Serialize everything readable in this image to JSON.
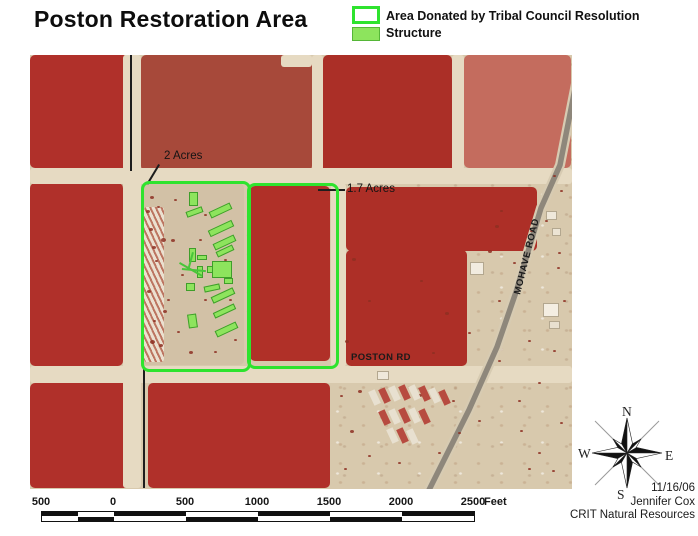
{
  "title": "Poston Restoration Area",
  "legend": {
    "items": [
      {
        "label": "Area Donated by Tribal Council Resolution",
        "swatch": "green-outline",
        "color": "#2ee32e"
      },
      {
        "label": "Structure",
        "swatch": "green-fill",
        "color": "#8de45d"
      }
    ]
  },
  "map": {
    "labels": {
      "area1": "2 Acres",
      "area2": "1.7 Acres",
      "poston_rd": "POSTON RD",
      "mohave_road": "MOHAVE ROAD"
    },
    "colors": {
      "boundary_green": "#2ee32e",
      "structure_green": "#8de45d",
      "field_red": "#b0302a",
      "desert_tan": "#d8c9ad"
    },
    "fields": [
      {
        "x": 0,
        "y": 0,
        "w": 98,
        "h": 113,
        "c": "#b0302a"
      },
      {
        "x": 111,
        "y": 0,
        "w": 171,
        "h": 116,
        "c": "#a7493a",
        "t": "mottled"
      },
      {
        "x": 293,
        "y": 0,
        "w": 129,
        "h": 118,
        "c": "#ab2f27",
        "t": "mottled"
      },
      {
        "x": 434,
        "y": 0,
        "w": 107,
        "h": 113,
        "c": "#c46c5e",
        "t": "mottled"
      },
      {
        "x": 0,
        "y": 128,
        "w": 93,
        "h": 183,
        "c": "#b0302a"
      },
      {
        "x": 316,
        "y": 132,
        "w": 191,
        "h": 64,
        "c": "#ad2f27"
      },
      {
        "x": 316,
        "y": 195,
        "w": 121,
        "h": 116,
        "c": "#ad2f27"
      },
      {
        "x": 220,
        "y": 131,
        "w": 80,
        "h": 175,
        "c": "#b03028"
      },
      {
        "x": 0,
        "y": 328,
        "w": 107,
        "h": 105,
        "c": "#b0302a"
      },
      {
        "x": 118,
        "y": 328,
        "w": 182,
        "h": 105,
        "c": "#b0302a"
      },
      {
        "x": 112,
        "y": 128,
        "w": 102,
        "h": 182,
        "c": "#d2c1a6",
        "t": "camp"
      },
      {
        "x": 114,
        "y": 152,
        "w": 20,
        "h": 155,
        "t": "ruins"
      }
    ],
    "roads": [
      {
        "x": 0,
        "y": 113,
        "w": 542,
        "h": 16
      },
      {
        "x": 0,
        "y": 311,
        "w": 542,
        "h": 17
      },
      {
        "x": 93,
        "y": 0,
        "w": 18,
        "h": 433
      },
      {
        "x": 282,
        "y": 0,
        "w": 11,
        "h": 115
      },
      {
        "x": 301,
        "y": 128,
        "w": 15,
        "h": 184
      },
      {
        "x": 422,
        "y": 0,
        "w": 12,
        "h": 115
      },
      {
        "x": 251,
        "y": 0,
        "w": 31,
        "h": 12
      }
    ],
    "dark_lines": [
      {
        "x": 100,
        "y": 0,
        "w": 2,
        "h": 116
      },
      {
        "x": 113,
        "y": 312,
        "w": 2,
        "h": 121
      },
      {
        "x": 288,
        "y": 134,
        "w": 27,
        "h": 2
      },
      {
        "x": 130,
        "y": 110,
        "w": 23,
        "h": 2,
        "r": 121
      }
    ],
    "parcels": [
      {
        "x": 111,
        "y": 126,
        "w": 104,
        "h": 185
      },
      {
        "x": 217,
        "y": 128,
        "w": 86,
        "h": 180
      }
    ],
    "structures": [
      {
        "x": 159,
        "y": 137,
        "w": 9,
        "h": 14
      },
      {
        "x": 156,
        "y": 154,
        "w": 17,
        "h": 6,
        "r": -20
      },
      {
        "x": 179,
        "y": 152,
        "w": 23,
        "h": 7,
        "r": -25
      },
      {
        "x": 178,
        "y": 170,
        "w": 26,
        "h": 7,
        "r": -25
      },
      {
        "x": 183,
        "y": 184,
        "w": 23,
        "h": 7,
        "r": -25
      },
      {
        "x": 186,
        "y": 193,
        "w": 18,
        "h": 6,
        "r": -25
      },
      {
        "x": 159,
        "y": 193,
        "w": 7,
        "h": 14
      },
      {
        "x": 167,
        "y": 200,
        "w": 10,
        "h": 5
      },
      {
        "x": 182,
        "y": 206,
        "w": 20,
        "h": 17
      },
      {
        "x": 177,
        "y": 211,
        "w": 6,
        "h": 7
      },
      {
        "x": 194,
        "y": 223,
        "w": 9,
        "h": 6
      },
      {
        "x": 167,
        "y": 211,
        "w": 6,
        "h": 12
      },
      {
        "x": 156,
        "y": 228,
        "w": 9,
        "h": 8
      },
      {
        "x": 174,
        "y": 230,
        "w": 16,
        "h": 6,
        "r": -12
      },
      {
        "x": 181,
        "y": 237,
        "w": 24,
        "h": 7,
        "r": -25
      },
      {
        "x": 183,
        "y": 253,
        "w": 23,
        "h": 6,
        "r": -25
      },
      {
        "x": 158,
        "y": 259,
        "w": 9,
        "h": 14,
        "r": -8
      },
      {
        "x": 185,
        "y": 271,
        "w": 23,
        "h": 7,
        "r": -25
      }
    ],
    "green_lines": [
      {
        "x": 150,
        "y": 207,
        "w": 26,
        "h": 2,
        "r": 30
      },
      {
        "x": 152,
        "y": 213,
        "w": 24,
        "h": 2,
        "r": 5
      },
      {
        "x": 162,
        "y": 197,
        "w": 2,
        "h": 18,
        "r": 15
      }
    ],
    "buildings": [
      {
        "x": 440,
        "y": 207,
        "w": 14,
        "h": 13,
        "c": "#f2ece0"
      },
      {
        "x": 513,
        "y": 248,
        "w": 16,
        "h": 14,
        "c": "#f4eee2"
      },
      {
        "x": 519,
        "y": 266,
        "w": 11,
        "h": 8,
        "c": "#e8e0d0"
      },
      {
        "x": 347,
        "y": 316,
        "w": 12,
        "h": 9,
        "c": "#efe8da"
      },
      {
        "x": 516,
        "y": 156,
        "w": 11,
        "h": 9,
        "c": "#efe8da"
      },
      {
        "x": 522,
        "y": 173,
        "w": 9,
        "h": 8,
        "c": "#ece4d4"
      }
    ],
    "trailers": [
      {
        "x": 341,
        "y": 335,
        "c": "#e9e1d2"
      },
      {
        "x": 351,
        "y": 333,
        "c": "#b5453a"
      },
      {
        "x": 361,
        "y": 331,
        "c": "#e9e1d2"
      },
      {
        "x": 371,
        "y": 330,
        "c": "#b5453a"
      },
      {
        "x": 381,
        "y": 330,
        "c": "#e9e1d2"
      },
      {
        "x": 391,
        "y": 331,
        "c": "#b5453a"
      },
      {
        "x": 401,
        "y": 333,
        "c": "#e9e1d2"
      },
      {
        "x": 411,
        "y": 335,
        "c": "#b5453a"
      },
      {
        "x": 351,
        "y": 355,
        "c": "#b5453a"
      },
      {
        "x": 361,
        "y": 354,
        "c": "#e9e1d2"
      },
      {
        "x": 371,
        "y": 353,
        "c": "#b5453a"
      },
      {
        "x": 381,
        "y": 353,
        "c": "#e9e1d2"
      },
      {
        "x": 391,
        "y": 354,
        "c": "#b5453a"
      },
      {
        "x": 359,
        "y": 373,
        "c": "#e9e1d2"
      },
      {
        "x": 369,
        "y": 373,
        "c": "#b5453a"
      },
      {
        "x": 379,
        "y": 374,
        "c": "#e9e1d2"
      }
    ],
    "bushes": [
      [
        120,
        141,
        4
      ],
      [
        127,
        151,
        3
      ],
      [
        119,
        173,
        4
      ],
      [
        125,
        205,
        3
      ],
      [
        117,
        235,
        4
      ],
      [
        123,
        265,
        3
      ],
      [
        129,
        289,
        4
      ],
      [
        144,
        144,
        3
      ],
      [
        141,
        184,
        4
      ],
      [
        137,
        244,
        3
      ],
      [
        147,
        276,
        3
      ],
      [
        174,
        159,
        3
      ],
      [
        169,
        184,
        3
      ],
      [
        194,
        204,
        3
      ],
      [
        199,
        244,
        3
      ],
      [
        159,
        296,
        4
      ],
      [
        184,
        296,
        3
      ],
      [
        204,
        284,
        3
      ],
      [
        174,
        244,
        3
      ],
      [
        151,
        219,
        3
      ],
      [
        131,
        183,
        5
      ],
      [
        133,
        255,
        4
      ],
      [
        120,
        285,
        5
      ],
      [
        116,
        155,
        4
      ],
      [
        122,
        191,
        4
      ],
      [
        322,
        203,
        4
      ],
      [
        338,
        245,
        3
      ],
      [
        390,
        225,
        3
      ],
      [
        415,
        257,
        4
      ],
      [
        438,
        277,
        3
      ],
      [
        468,
        305,
        3
      ],
      [
        315,
        285,
        4
      ],
      [
        402,
        297,
        3
      ],
      [
        328,
        335,
        4
      ],
      [
        320,
        375,
        4
      ],
      [
        314,
        413,
        3
      ],
      [
        338,
        400,
        3
      ],
      [
        368,
        407,
        3
      ],
      [
        408,
        397,
        3
      ],
      [
        428,
        377,
        3
      ],
      [
        448,
        365,
        3
      ],
      [
        488,
        345,
        3
      ],
      [
        508,
        327,
        3
      ],
      [
        523,
        295,
        3
      ],
      [
        498,
        285,
        3
      ],
      [
        468,
        245,
        3
      ],
      [
        458,
        195,
        4
      ],
      [
        483,
        207,
        3
      ],
      [
        528,
        197,
        3
      ],
      [
        533,
        245,
        3
      ],
      [
        388,
        339,
        4
      ],
      [
        422,
        345,
        3
      ],
      [
        310,
        340,
        3
      ],
      [
        490,
        375,
        3
      ],
      [
        508,
        397,
        3
      ],
      [
        530,
        367,
        3
      ],
      [
        498,
        413,
        3
      ],
      [
        522,
        415,
        3
      ],
      [
        470,
        155,
        3
      ],
      [
        500,
        175,
        3
      ],
      [
        465,
        170,
        4
      ],
      [
        530,
        135,
        3
      ],
      [
        523,
        120,
        3
      ],
      [
        515,
        165,
        3
      ],
      [
        527,
        212,
        3
      ]
    ]
  },
  "scalebar": {
    "unit": "Feet",
    "labels": [
      {
        "t": "500",
        "x": 41
      },
      {
        "t": "0",
        "x": 113
      },
      {
        "t": "500",
        "x": 185
      },
      {
        "t": "1000",
        "x": 257
      },
      {
        "t": "1500",
        "x": 329
      },
      {
        "t": "2000",
        "x": 401
      },
      {
        "t": "2500",
        "x": 473
      }
    ],
    "top_segments": [
      [
        41,
        77,
        "k"
      ],
      [
        77,
        113,
        "w"
      ],
      [
        113,
        185,
        "k"
      ],
      [
        185,
        257,
        "w"
      ],
      [
        257,
        329,
        "k"
      ],
      [
        329,
        401,
        "w"
      ],
      [
        401,
        473,
        "k"
      ]
    ],
    "bottom_segments": [
      [
        41,
        77,
        "w"
      ],
      [
        77,
        113,
        "k"
      ],
      [
        113,
        185,
        "w"
      ],
      [
        185,
        257,
        "k"
      ],
      [
        257,
        329,
        "w"
      ],
      [
        329,
        401,
        "k"
      ],
      [
        401,
        473,
        "w"
      ]
    ]
  },
  "compass": {
    "n": "N",
    "e": "E",
    "s": "S",
    "w": "W"
  },
  "credits": {
    "date": "11/16/06",
    "author": "Jennifer Cox",
    "org": "CRIT Natural Resources"
  }
}
